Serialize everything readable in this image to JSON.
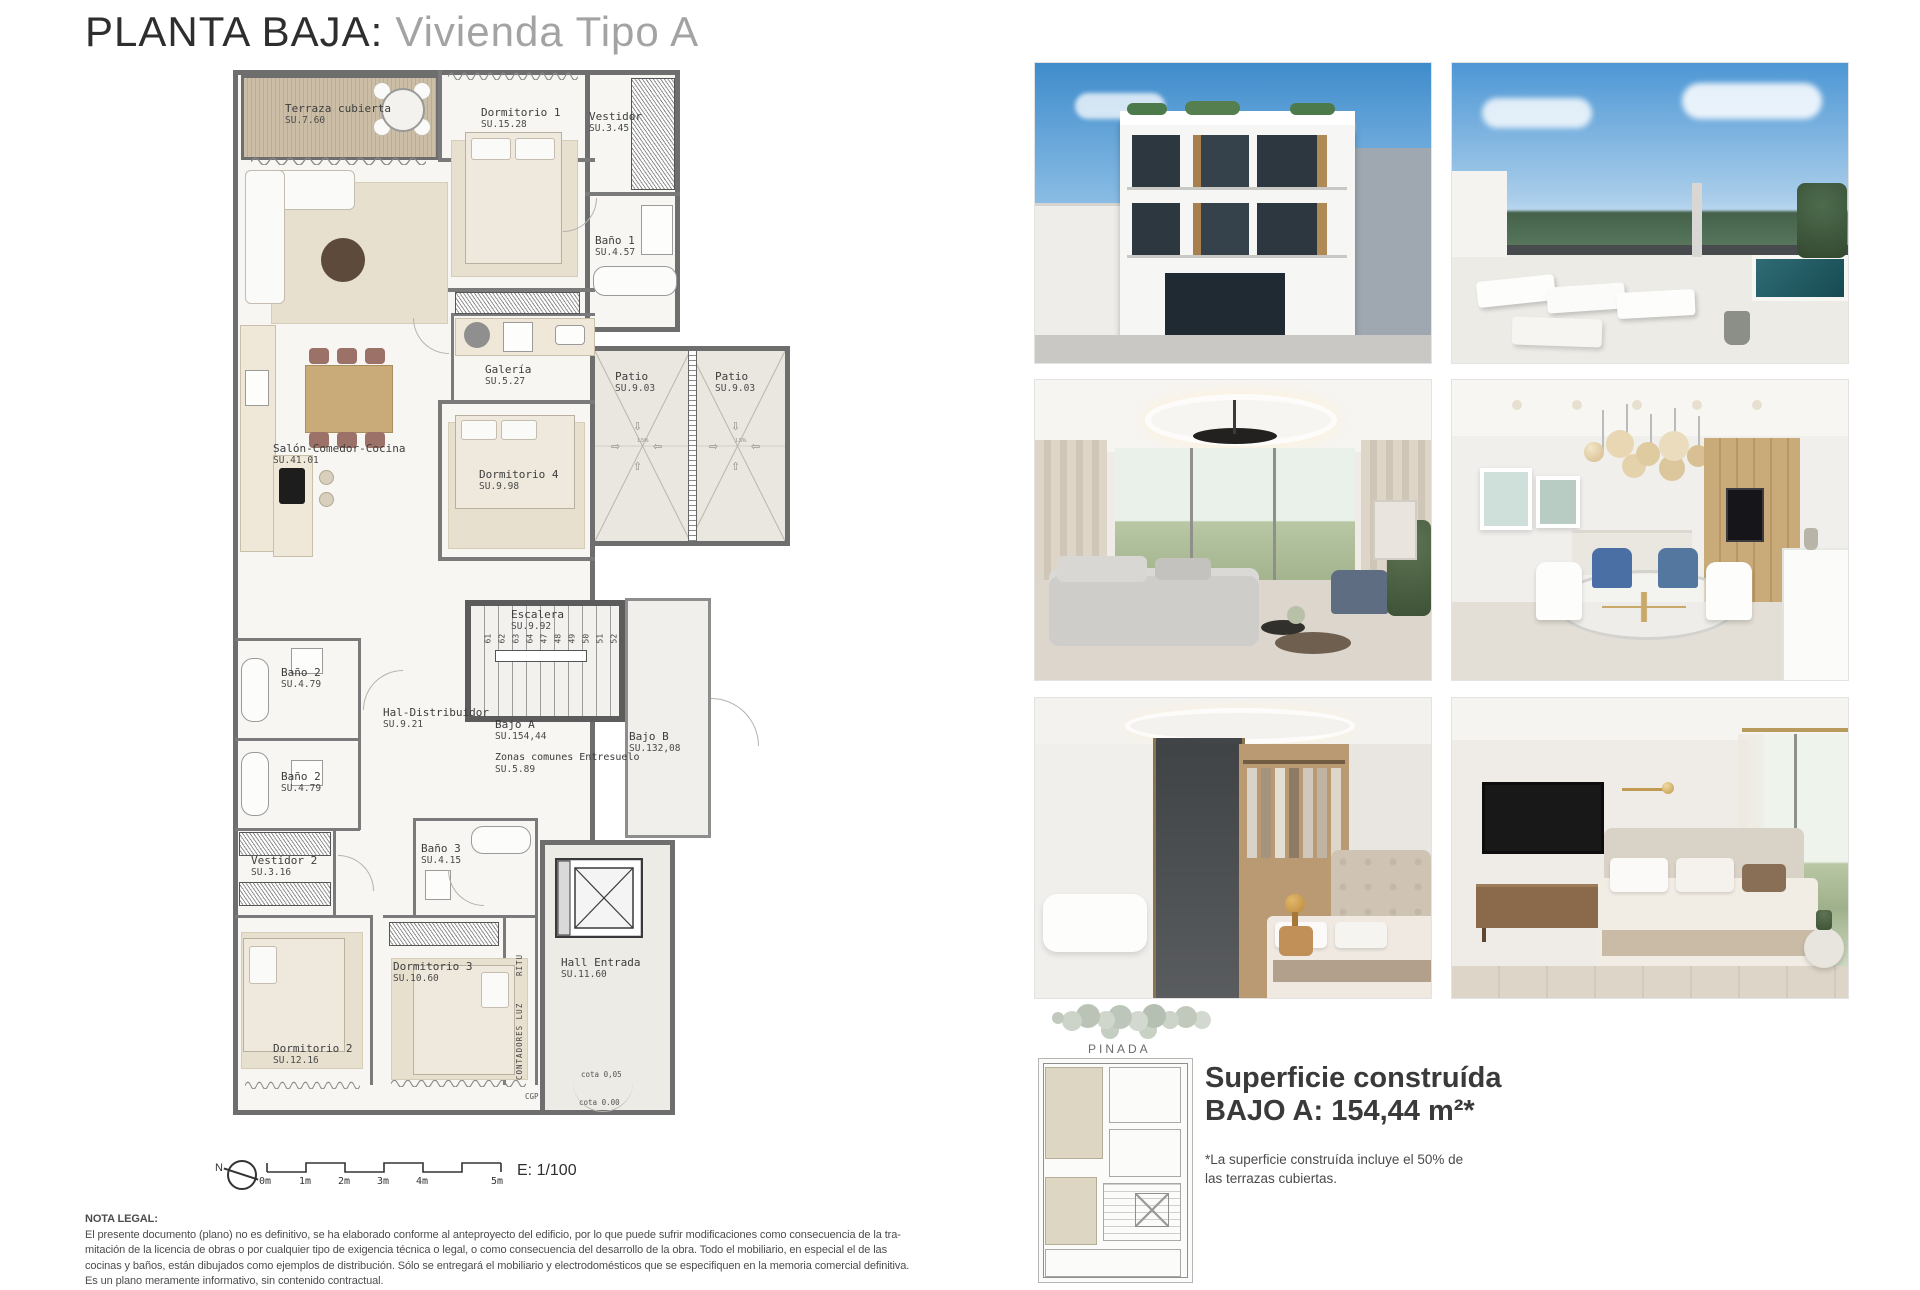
{
  "title": {
    "main": "PLANTA BAJA:",
    "sub": "Vivienda Tipo A"
  },
  "colors": {
    "wall": "#6e6e6e",
    "patio": "#eae7e0",
    "wood_deck": "#c9bba3",
    "sky": "#4f96d2"
  },
  "plan": {
    "rooms": [
      {
        "name": "Terraza cubierta",
        "su": "SU.7.60"
      },
      {
        "name": "Dormitorio 1",
        "su": "SU.15.28"
      },
      {
        "name": "Vestidor",
        "su": "SU.3.45"
      },
      {
        "name": "Baño 1",
        "su": "SU.4.57"
      },
      {
        "name": "Salón-Comedor-Cocina",
        "su": "SU.41.01"
      },
      {
        "name": "Galería",
        "su": "SU.5.27"
      },
      {
        "name": "Dormitorio 4",
        "su": "SU.9.98"
      },
      {
        "name": "Patio",
        "su": "SU.9.03"
      },
      {
        "name": "Patio",
        "su": "SU.9.03"
      },
      {
        "name": "Escalera",
        "su": "SU.9.92"
      },
      {
        "name": "Baño 2",
        "su": "SU.4.79"
      },
      {
        "name": "Baño 2",
        "su": "SU.4.79"
      },
      {
        "name": "Hal-Distribuidor",
        "su": "SU.9.21"
      },
      {
        "name": "Bajo A",
        "su": "SU.154,44"
      },
      {
        "name": "Zonas comunes Entresuelo",
        "su": "SU.5.89"
      },
      {
        "name": "Bajo B",
        "su": "SU.132,08"
      },
      {
        "name": "Vestidor 2",
        "su": "SU.3.16"
      },
      {
        "name": "Baño 3",
        "su": "SU.4.15"
      },
      {
        "name": "Dormitorio 3",
        "su": "SU.10.60"
      },
      {
        "name": "Dormitorio 2",
        "su": "SU.12.16"
      },
      {
        "name": "Hall Entrada",
        "su": "SU.11.60"
      }
    ],
    "stairs": {
      "numbers": [
        "61",
        "62",
        "63",
        "64",
        "47",
        "48",
        "49",
        "50",
        "51",
        "52"
      ]
    },
    "annotations": {
      "ritu": "RITU",
      "contadores": "CONTADORES LUZ",
      "cgp": "CGP",
      "cota_top": "cota 0,05",
      "cota_bottom": "cota 0.00",
      "slope": "1.5%"
    },
    "scale": {
      "north": "N",
      "ticks": [
        "0m",
        "1m",
        "2m",
        "3m",
        "4m",
        "5m"
      ],
      "ratio": "E: 1/100"
    }
  },
  "summary": {
    "pinada": "PINADA",
    "title_line1": "Superficie construída",
    "title_line2": "BAJO A: 154,44 m²*",
    "note_line1": "*La superficie construída incluye el 50% de",
    "note_line2": "las terrazas cubiertas."
  },
  "legal": {
    "header": "NOTA LEGAL:",
    "lines": [
      "El presente documento (plano) no es definitivo, se ha elaborado conforme al anteproyecto del edificio, por lo que puede sufrir modificaciones como consecuencia de la tra-",
      "mitación de la licencia de obras o por cualquier tipo de exigencia técnica o legal, o como consecuencia del desarrollo de la obra. Todo el mobiliario, en especial el de las",
      "cocinas y baños, están dibujados como ejemplos de distribución. Sólo se entregará el mobiliario y electrodomésticos que se especifiquen en la memoria comercial definitiva.",
      "Es un plano meramente informativo, sin contenido contractual."
    ]
  }
}
